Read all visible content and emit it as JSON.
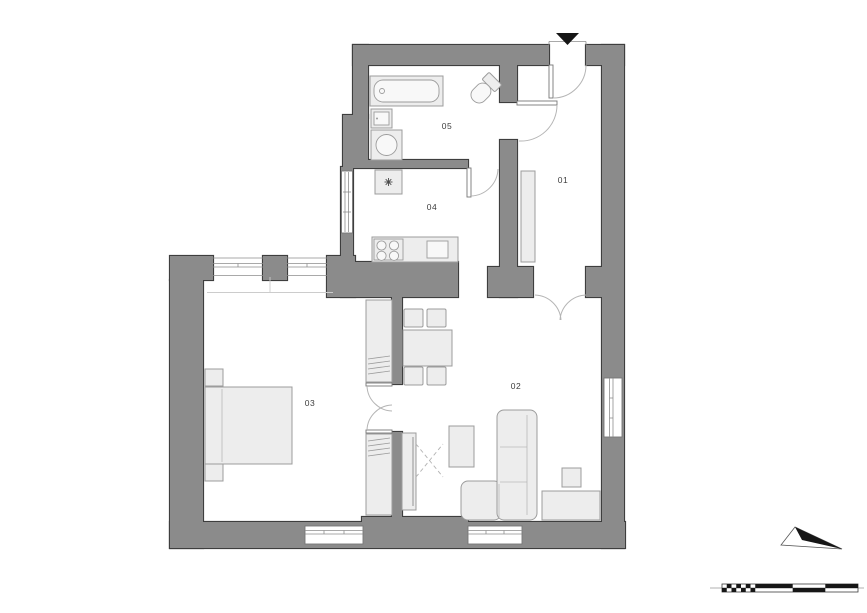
{
  "plan": {
    "room_labels": [
      "01",
      "02",
      "03",
      "04",
      "05"
    ]
  },
  "icons": {
    "north_arrow": "▼",
    "orientation_arrow": "➤",
    "boiler_symbol": "✳"
  },
  "colors": {
    "wall_fill": "#8b8b8b",
    "wall_stroke": "#3e3e3e",
    "fixture_fill": "#ededed",
    "fixture_stroke": "#9c9c9c",
    "fixture_light": "#f8f8f8",
    "door_leaf_stroke": "#777777",
    "door_arc": "#b5b5b5",
    "window_line": "#767676",
    "label_text": "#3c3c3c",
    "icon_black": "#161616"
  }
}
